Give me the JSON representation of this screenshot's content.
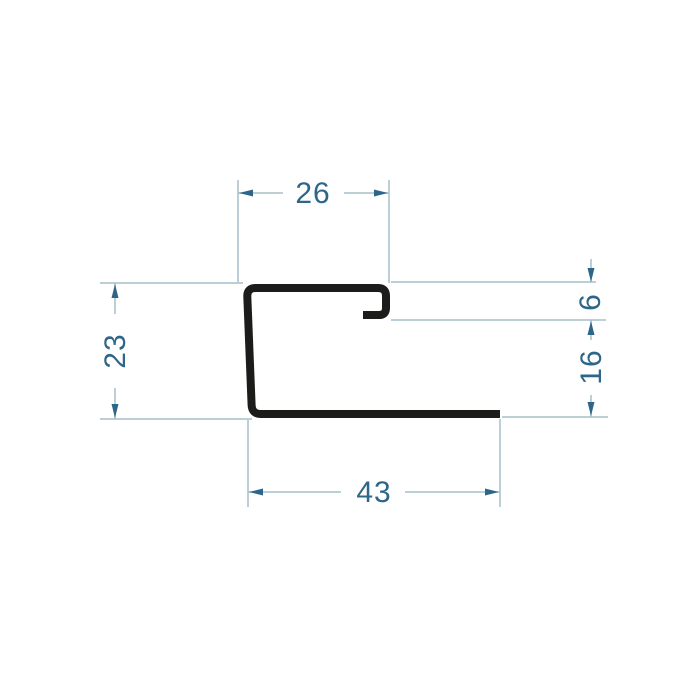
{
  "page": {
    "background_color": "#ffffff"
  },
  "drawing": {
    "profile_color": "#1c1c1a",
    "dimension_line_color": "#a5bfca",
    "dimension_text_color": "#2e6689",
    "dimensions": {
      "top_width": "26",
      "height_left": "23",
      "lip_drop": "6",
      "right_height": "16",
      "bottom_width": "43"
    }
  }
}
